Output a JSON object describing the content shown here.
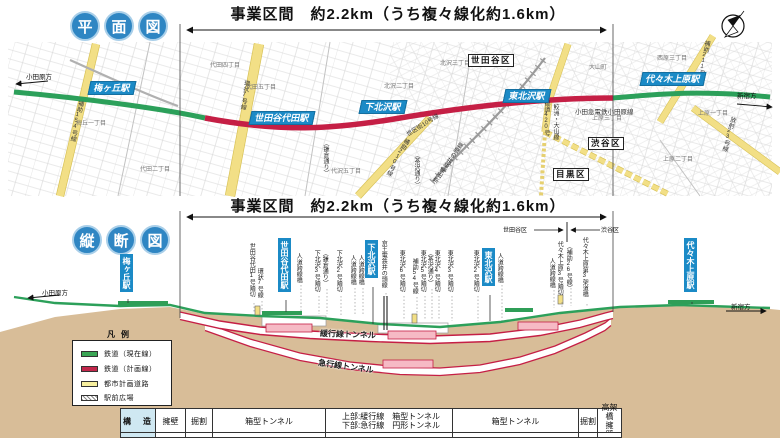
{
  "plan": {
    "badge": {
      "chars": [
        "平",
        "面",
        "図"
      ]
    },
    "title": "事業区間　約2.2km（うち複々線化約1.6km）",
    "dir_left": "小田原方",
    "dir_right": "新宿方",
    "railway": "小田急電鉄小田原線",
    "stations": [
      {
        "label": "梅ヶ丘駅"
      },
      {
        "label": "世田谷代田駅"
      },
      {
        "label": "下北沢駅"
      },
      {
        "label": "東北沢駅"
      },
      {
        "label": "代々木上原駅"
      }
    ],
    "wards": [
      {
        "label": "世田谷区"
      },
      {
        "label": "渋谷区"
      },
      {
        "label": "目黒区"
      }
    ],
    "roads": [
      {
        "label": "補助154号線"
      },
      {
        "label": "環状7号線"
      },
      {
        "label": "補助210号線"
      },
      {
        "label": "世区街10号線"
      },
      {
        "label": "京王電鉄井の頭線"
      },
      {
        "label": "（鎌倉通り）"
      },
      {
        "label": "（茶沢通り）"
      },
      {
        "label": "都道420号"
      },
      {
        "label": "鮫洲・大山線"
      },
      {
        "label": "放射23号線"
      },
      {
        "label": "補助211号線"
      }
    ],
    "districts": [
      {
        "label": "代田四丁目"
      },
      {
        "label": "代田五丁目"
      },
      {
        "label": "梅丘一丁目"
      },
      {
        "label": "代田二丁目"
      },
      {
        "label": "代沢五丁目"
      },
      {
        "label": "北沢三丁目"
      },
      {
        "label": "北沢二丁目"
      },
      {
        "label": "大山町"
      },
      {
        "label": "西原三丁目"
      },
      {
        "label": "上原三丁目"
      },
      {
        "label": "上原一丁目"
      },
      {
        "label": "上原二丁目"
      }
    ]
  },
  "profile": {
    "badge": {
      "chars": [
        "縦",
        "断",
        "図"
      ]
    },
    "title": "事業区間　約2.2km（うち複々線化約1.6km）",
    "dir_left": "小田原方",
    "dir_right": "新宿方",
    "boundary_left": "世田谷区",
    "boundary_right": "渋谷区",
    "stations": [
      {
        "label": "梅ヶ丘駅"
      },
      {
        "label": "世田谷代田駅"
      },
      {
        "label": "下北沢駅"
      },
      {
        "label": "東北沢駅"
      },
      {
        "label": "代々木上原駅"
      }
    ],
    "crossings": [
      {
        "label": "世田谷代田1号踏切"
      },
      {
        "label": "環状7号線"
      },
      {
        "label": "人道跨線橋"
      },
      {
        "label": "下北沢3号踏切"
      },
      {
        "label": "（鎌倉通り）"
      },
      {
        "label": "下北沢2号踏切"
      },
      {
        "label": "人道跨線橋"
      },
      {
        "label": "人道跨線橋"
      },
      {
        "label": "京王電鉄井の頭線"
      },
      {
        "label": "東北沢6号踏切"
      },
      {
        "label": "補助54号線"
      },
      {
        "label": "東北沢5号踏切"
      },
      {
        "label": "（茶沢通り）"
      },
      {
        "label": "東北沢4号踏切"
      },
      {
        "label": "東北沢3号踏切"
      },
      {
        "label": "東北沢2号踏切"
      },
      {
        "label": "人道跨線橋"
      },
      {
        "label": "人道跨線橋"
      },
      {
        "label": "代々木上原3号踏切"
      },
      {
        "label": "（補助26号線）"
      },
      {
        "label": "代々木上原第3架道橋"
      }
    ],
    "tunnel_upper": "緩行線トンネル",
    "tunnel_lower": "急行線トンネル",
    "legend": {
      "title": "凡例",
      "items": [
        {
          "label": "鉄道（現在線）",
          "color": "#3aa655"
        },
        {
          "label": "鉄道（計画線）",
          "color": "#c2274b"
        },
        {
          "label": "都市計画道路",
          "color": "#f7ef9e"
        },
        {
          "label": "駅前広場",
          "color": "hatch"
        }
      ]
    }
  },
  "table": {
    "header": "構　造",
    "c1": "擁壁",
    "c2": "掘割",
    "c3": "箱型トンネル",
    "c4a": "上部:緩行線　箱型トンネル",
    "c4b": "下部:急行線　円形トンネル",
    "c5": "箱型トンネル",
    "c6": "掘割",
    "c7a": "高架橋",
    "c7b": "擁　壁"
  },
  "colors": {
    "station_blue": "#1b8ac6",
    "current_line_green": "#2ca05a",
    "planned_line_red": "#c51f45",
    "road_yellow": "#f2df86",
    "earth_tan": "#d8bd98"
  }
}
